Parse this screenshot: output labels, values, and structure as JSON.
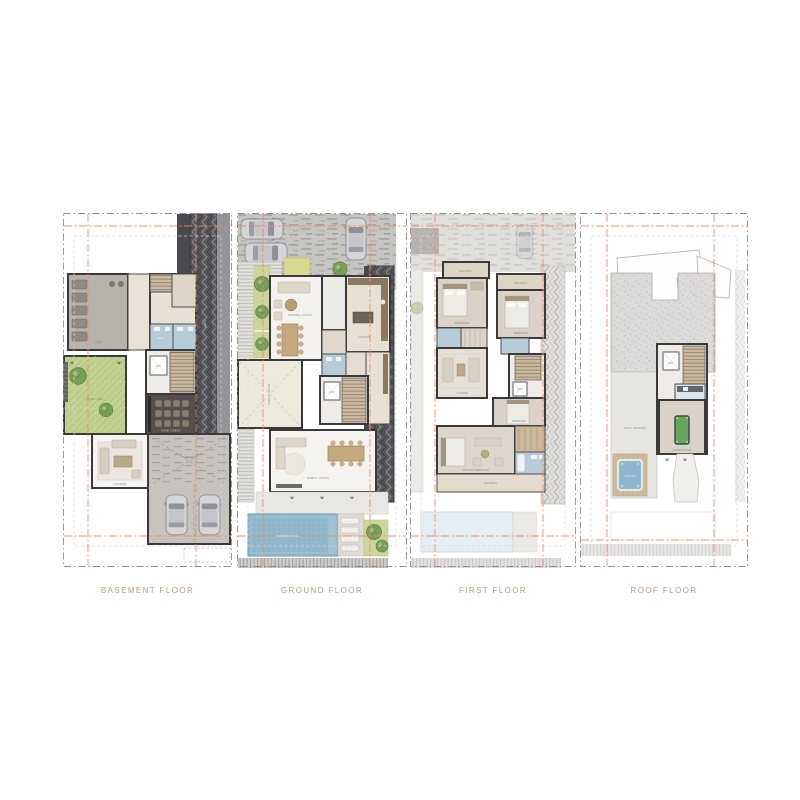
{
  "page": {
    "background": "#ffffff",
    "caption_color": "#b59b80",
    "accent_setback_line": "#eb8a66",
    "boundary_line": "#8e8e8e",
    "window_mark": "W"
  },
  "floors": {
    "basement": {
      "caption": "BASEMENT FLOOR",
      "rooms": {
        "gym": "GYM",
        "bath": "BATH",
        "lift": "LIFT",
        "cinema": "HOME CINEMA",
        "courtyard": "COURTYARD",
        "lounge": "LOUNGE",
        "garage": "GARAGE",
        "ramp": "RAMP"
      }
    },
    "ground": {
      "caption": "GROUND FLOOR",
      "rooms": {
        "living": "FORMAL LIVING",
        "kitchen": "KITCHEN",
        "guest": "GUEST ROOM",
        "lift": "LIFT",
        "family": "FAMILY LIVING",
        "pool": "SWIMMING POOL"
      }
    },
    "first": {
      "caption": "FIRST FLOOR",
      "rooms": {
        "balcony1": "BALCONY",
        "balcony2": "BALCONY",
        "bed1": "BEDROOM",
        "bed2": "BEDROOM",
        "lounge": "LOUNGE",
        "lift": "LIFT",
        "bed3": "BEDROOM",
        "master": "MASTER BEDROOM",
        "balcony3": "BALCONY"
      }
    },
    "roof": {
      "caption": "ROOF FLOOR",
      "rooms": {
        "lift": "LIFT",
        "games": "GAMES ROOM",
        "terrace": "ROOF TERRACE",
        "jacuzzi": "JACUZZI"
      }
    }
  }
}
